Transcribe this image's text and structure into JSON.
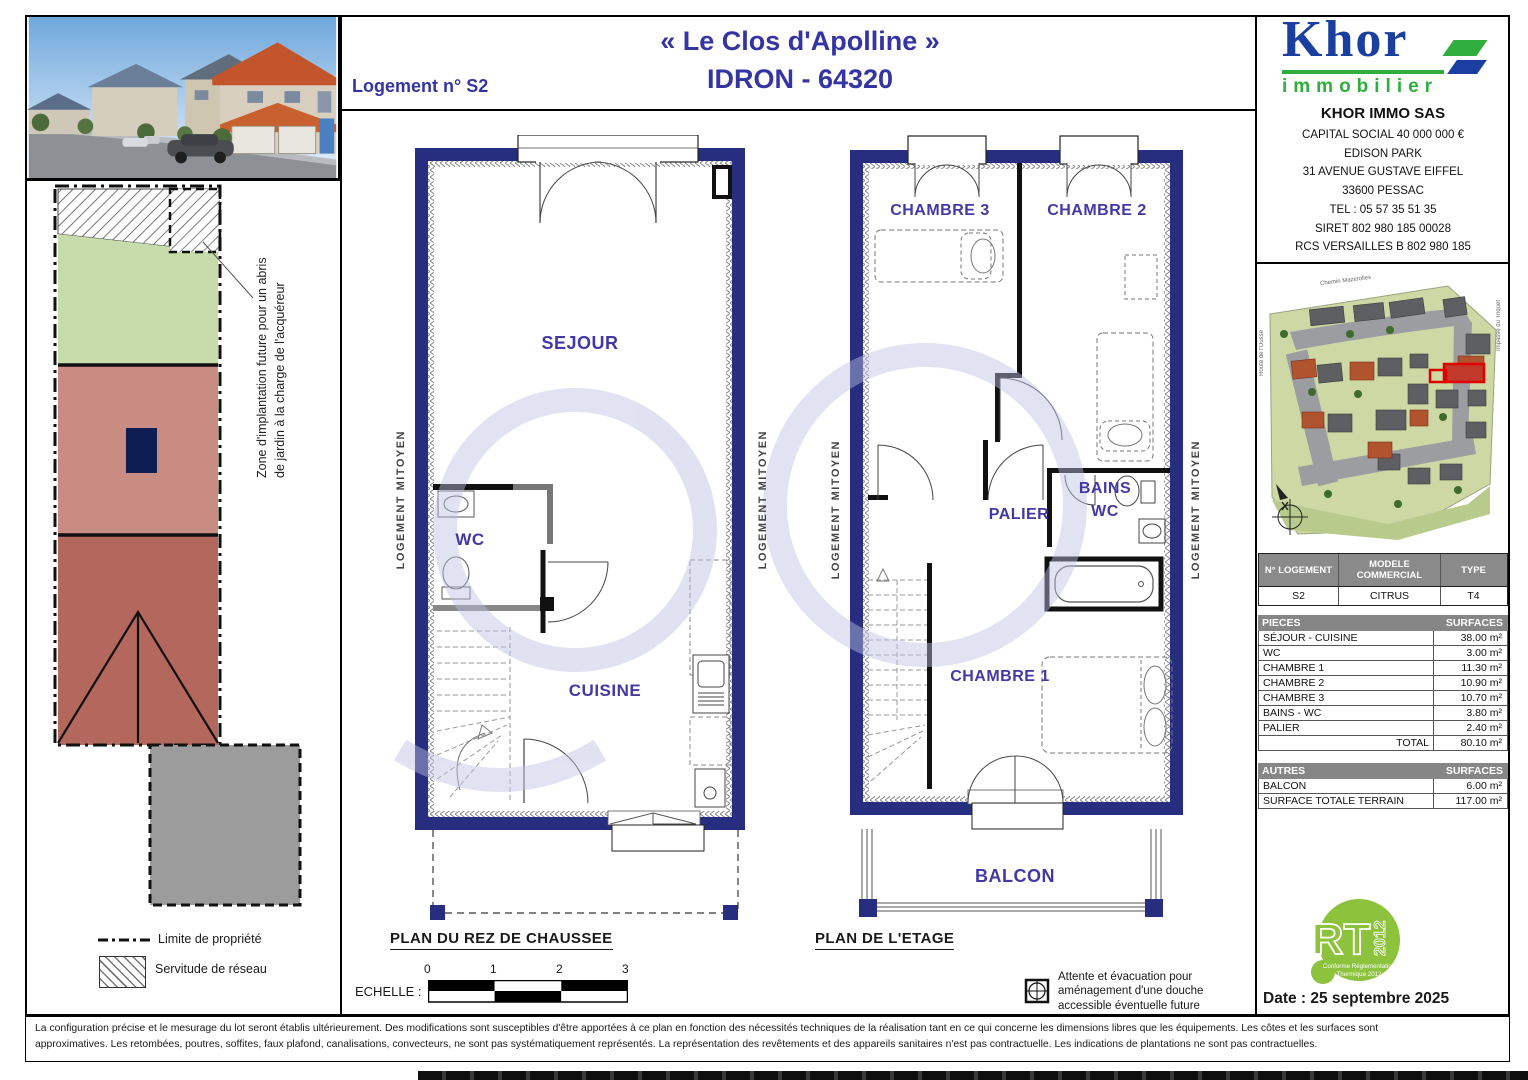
{
  "header": {
    "logement_label": "Logement n° S2",
    "title_line1": "« Le Clos d'Apolline »",
    "title_line2": "IDRON - 64320"
  },
  "branding": {
    "logo_word": "Khor",
    "logo_sub": "immobilier",
    "company_name": "KHOR IMMO SAS",
    "company_lines": [
      "CAPITAL SOCIAL 40 000 000 €",
      "EDISON PARK",
      "31 AVENUE GUSTAVE EIFFEL",
      "33600 PESSAC",
      "TEL : 05 57 35 51 35",
      "SIRET 802 980 185 00028",
      "RCS VERSAILLES B 802 980 185"
    ],
    "brand_blue": "#1b3fa0",
    "brand_green": "#2fae3e"
  },
  "site_map": {
    "street_top": "Chemin Mazerolles",
    "street_left": "Route de l'Ousse",
    "street_right": "Impasse du Triquet"
  },
  "plot": {
    "zone_note": "Zone d'implantation future pour un abris de jardin à la charge de l'acquéreur"
  },
  "legend": {
    "limite": "Limite de propriété",
    "servitude": "Servitude de réseau"
  },
  "plans": {
    "party_wall_label": "LOGEMENT MITOYEN",
    "ground": {
      "title": "PLAN DU REZ DE CHAUSSEE",
      "rooms": {
        "sejour": "SEJOUR",
        "wc": "WC",
        "cuisine": "CUISINE"
      }
    },
    "upper": {
      "title": "PLAN DE L'ETAGE",
      "rooms": {
        "chambre3": "CHAMBRE 3",
        "chambre2": "CHAMBRE 2",
        "palier": "PALIER",
        "bains": "BAINS",
        "wc": "WC",
        "chambre1": "CHAMBRE 1",
        "balcon": "BALCON"
      }
    }
  },
  "scale": {
    "label": "ECHELLE :",
    "ticks": [
      "0",
      "1",
      "2",
      "3"
    ]
  },
  "notes": {
    "shower": "Attente et évacuation pour aménagement d'une douche accessible éventuelle future"
  },
  "info_table": {
    "headers": [
      "N° LOGEMENT",
      "MODELE COMMERCIAL",
      "TYPE"
    ],
    "row": [
      "S2",
      "CITRUS",
      "T4"
    ]
  },
  "pieces_table": {
    "header_left": "PIECES",
    "header_right": "SURFACES",
    "rows": [
      [
        "SÉJOUR - CUISINE",
        "38.00 m²"
      ],
      [
        "WC",
        "3.00 m²"
      ],
      [
        "CHAMBRE 1",
        "11.30 m²"
      ],
      [
        "CHAMBRE 2",
        "10.90 m²"
      ],
      [
        "CHAMBRE 3",
        "10.70 m²"
      ],
      [
        "BAINS - WC",
        "3.80 m²"
      ],
      [
        "PALIER",
        "2.40 m²"
      ]
    ],
    "total_label": "TOTAL",
    "total_value": "80.10 m²"
  },
  "autres_table": {
    "header_left": "AUTRES",
    "header_right": "SURFACES",
    "rows": [
      [
        "BALCON",
        "6.00 m²"
      ],
      [
        "SURFACE TOTALE TERRAIN",
        "117.00 m²"
      ]
    ]
  },
  "rt": {
    "big": "RT",
    "year": "2012",
    "sub1": "Conforme Réglementation",
    "sub2": "Thermique 2012"
  },
  "date_label": "Date : 25 septembre 2025",
  "disclaimer": {
    "line1": "La configuration précise et le mesurage du lot seront établis ultérieurement. Des modifications sont susceptibles d'être apportées à ce plan en fonction des nécessités techniques de la réalisation tant en ce qui concerne les dimensions libres que les équipements. Les côtes et les surfaces sont",
    "line2": "approximatives. Les retombées, poutres, soffites, faux plafond, canalisations, convecteurs, ne sont pas systématiquement représentés. La représentation des revêtements et des appareils sanitaires n'est pas contractuelle. Les indications de plantations ne sont pas contractuelles."
  }
}
